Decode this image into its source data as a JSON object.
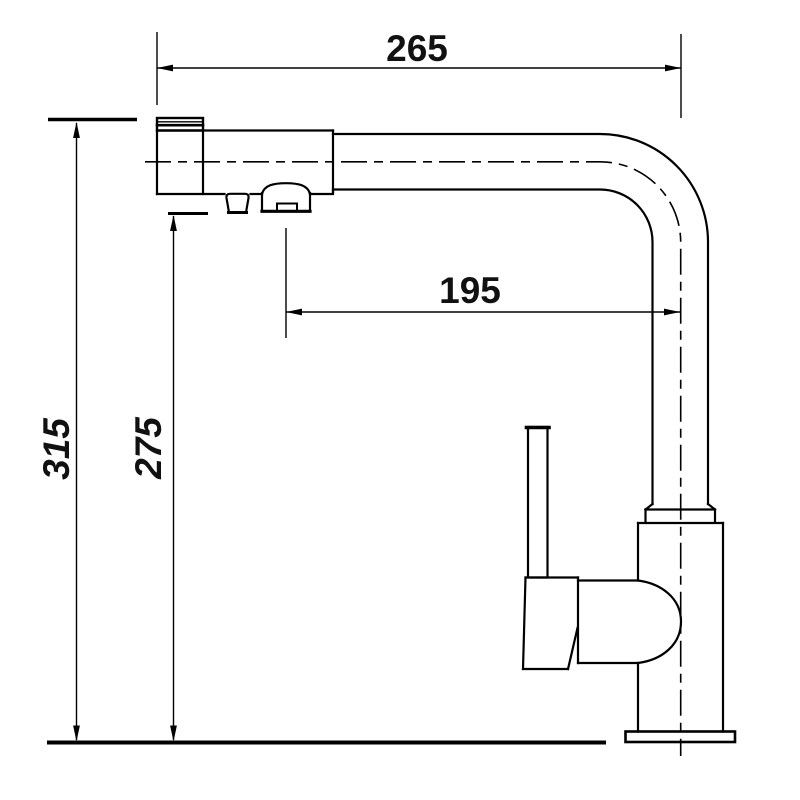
{
  "drawing": {
    "background": "#ffffff",
    "line_color": "#000000",
    "text_color": "#111111"
  },
  "dimensions": {
    "spout_width_top": {
      "label": "265"
    },
    "spout_reach": {
      "label": "195"
    },
    "overall_height": {
      "label": "315"
    },
    "outlet_height": {
      "label": "275"
    }
  }
}
